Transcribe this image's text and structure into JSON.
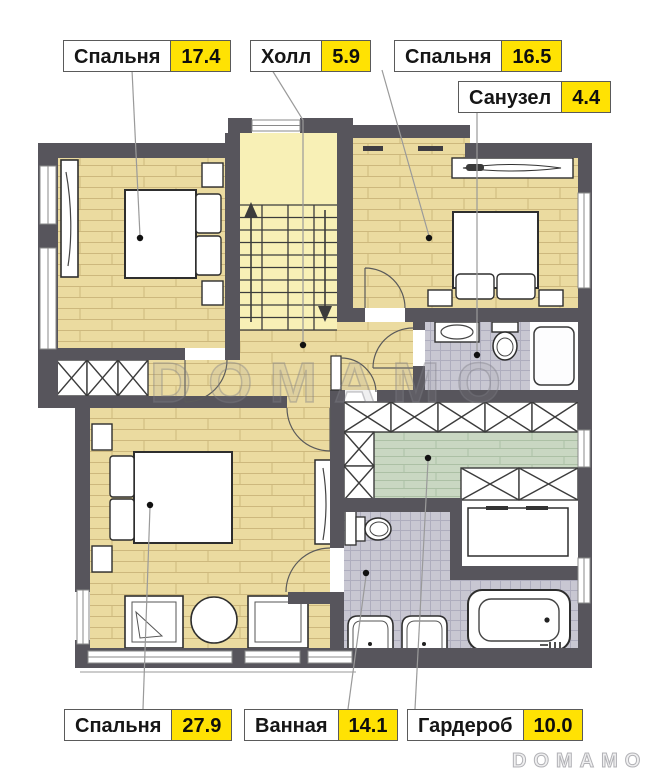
{
  "watermark": {
    "center": "DOMAMO",
    "corner": "DOMAMO"
  },
  "colors": {
    "wall": "#57555C",
    "wood_floor": "#EBDBA0",
    "stair_floor": "#F8F0B6",
    "green_floor": "#C9D7C2",
    "tile_floor": "#C8C7D2",
    "label_yellow": "#FFE203"
  },
  "rooms": [
    {
      "id": "bedroom-top-left",
      "label": "Спальня",
      "area": "17.4"
    },
    {
      "id": "hall",
      "label": "Холл",
      "area": "5.9"
    },
    {
      "id": "bedroom-top-right",
      "label": "Спальня",
      "area": "16.5"
    },
    {
      "id": "wc",
      "label": "Санузел",
      "area": "4.4"
    },
    {
      "id": "bedroom-bottom",
      "label": "Спальня",
      "area": "27.9"
    },
    {
      "id": "bathroom",
      "label": "Ванная",
      "area": "14.1"
    },
    {
      "id": "wardrobe",
      "label": "Гардероб",
      "area": "10.0"
    }
  ]
}
